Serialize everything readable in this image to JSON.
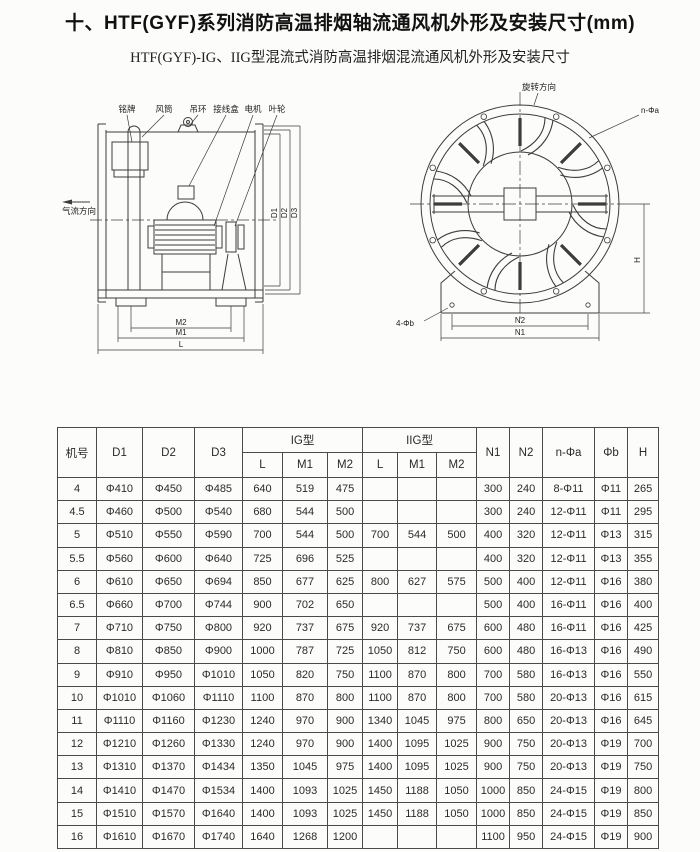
{
  "page": {
    "title": "十、HTF(GYF)系列消防高温排烟轴流通风机外形及安装尺寸(mm)",
    "subtitle": "HTF(GYF)-IG、IIG型混流式消防高温排烟混流通风机外形及安装尺寸"
  },
  "figures": {
    "side_view": {
      "part_labels": [
        "铭牌",
        "风筒",
        "吊环",
        "接线盒",
        "电机",
        "叶轮"
      ],
      "airflow_label": "气流方向",
      "dims": {
        "d1": "D1",
        "d2": "D2",
        "d3": "D3",
        "m1": "M1",
        "m2": "M2",
        "l": "L"
      }
    },
    "front_view": {
      "rotation_label": "旋转方向",
      "flange_holes_label": "n-Φa",
      "foot_holes_label": "4-Φb",
      "dims": {
        "n1": "N1",
        "n2": "N2",
        "h": "H"
      }
    }
  },
  "table": {
    "top_headers": [
      "机号",
      "D1",
      "D2",
      "D3",
      "IG型",
      "IIG型",
      "N1",
      "N2",
      "n-Φa",
      "Φb",
      "H"
    ],
    "sub_headers": [
      "L",
      "M1",
      "M2",
      "L",
      "M1",
      "M2"
    ],
    "rows": [
      [
        "4",
        "Φ410",
        "Φ450",
        "Φ485",
        "640",
        "519",
        "475",
        "",
        "",
        "",
        "300",
        "240",
        "8-Φ11",
        "Φ11",
        "265"
      ],
      [
        "4.5",
        "Φ460",
        "Φ500",
        "Φ540",
        "680",
        "544",
        "500",
        "",
        "",
        "",
        "300",
        "240",
        "12-Φ11",
        "Φ11",
        "295"
      ],
      [
        "5",
        "Φ510",
        "Φ550",
        "Φ590",
        "700",
        "544",
        "500",
        "700",
        "544",
        "500",
        "400",
        "320",
        "12-Φ11",
        "Φ13",
        "315"
      ],
      [
        "5.5",
        "Φ560",
        "Φ600",
        "Φ640",
        "725",
        "696",
        "525",
        "",
        "",
        "",
        "400",
        "320",
        "12-Φ11",
        "Φ13",
        "355"
      ],
      [
        "6",
        "Φ610",
        "Φ650",
        "Φ694",
        "850",
        "677",
        "625",
        "800",
        "627",
        "575",
        "500",
        "400",
        "12-Φ11",
        "Φ16",
        "380"
      ],
      [
        "6.5",
        "Φ660",
        "Φ700",
        "Φ744",
        "900",
        "702",
        "650",
        "",
        "",
        "",
        "500",
        "400",
        "16-Φ11",
        "Φ16",
        "400"
      ],
      [
        "7",
        "Φ710",
        "Φ750",
        "Φ800",
        "920",
        "737",
        "675",
        "920",
        "737",
        "675",
        "600",
        "480",
        "16-Φ11",
        "Φ16",
        "425"
      ],
      [
        "8",
        "Φ810",
        "Φ850",
        "Φ900",
        "1000",
        "787",
        "725",
        "1050",
        "812",
        "750",
        "600",
        "480",
        "16-Φ13",
        "Φ16",
        "490"
      ],
      [
        "9",
        "Φ910",
        "Φ950",
        "Φ1010",
        "1050",
        "820",
        "750",
        "1100",
        "870",
        "800",
        "700",
        "580",
        "16-Φ13",
        "Φ16",
        "550"
      ],
      [
        "10",
        "Φ1010",
        "Φ1060",
        "Φ1110",
        "1100",
        "870",
        "800",
        "1100",
        "870",
        "800",
        "700",
        "580",
        "20-Φ13",
        "Φ16",
        "615"
      ],
      [
        "11",
        "Φ1110",
        "Φ1160",
        "Φ1230",
        "1240",
        "970",
        "900",
        "1340",
        "1045",
        "975",
        "800",
        "650",
        "20-Φ13",
        "Φ16",
        "645"
      ],
      [
        "12",
        "Φ1210",
        "Φ1260",
        "Φ1330",
        "1240",
        "970",
        "900",
        "1400",
        "1095",
        "1025",
        "900",
        "750",
        "20-Φ13",
        "Φ19",
        "700"
      ],
      [
        "13",
        "Φ1310",
        "Φ1370",
        "Φ1434",
        "1350",
        "1045",
        "975",
        "1400",
        "1095",
        "1025",
        "900",
        "750",
        "20-Φ13",
        "Φ19",
        "750"
      ],
      [
        "14",
        "Φ1410",
        "Φ1470",
        "Φ1534",
        "1400",
        "1093",
        "1025",
        "1450",
        "1188",
        "1050",
        "1000",
        "850",
        "24-Φ15",
        "Φ19",
        "800"
      ],
      [
        "15",
        "Φ1510",
        "Φ1570",
        "Φ1640",
        "1400",
        "1093",
        "1025",
        "1450",
        "1188",
        "1050",
        "1000",
        "850",
        "24-Φ15",
        "Φ19",
        "850"
      ],
      [
        "16",
        "Φ1610",
        "Φ1670",
        "Φ1740",
        "1640",
        "1268",
        "1200",
        "",
        "",
        "",
        "1100",
        "950",
        "24-Φ15",
        "Φ19",
        "900"
      ]
    ]
  }
}
